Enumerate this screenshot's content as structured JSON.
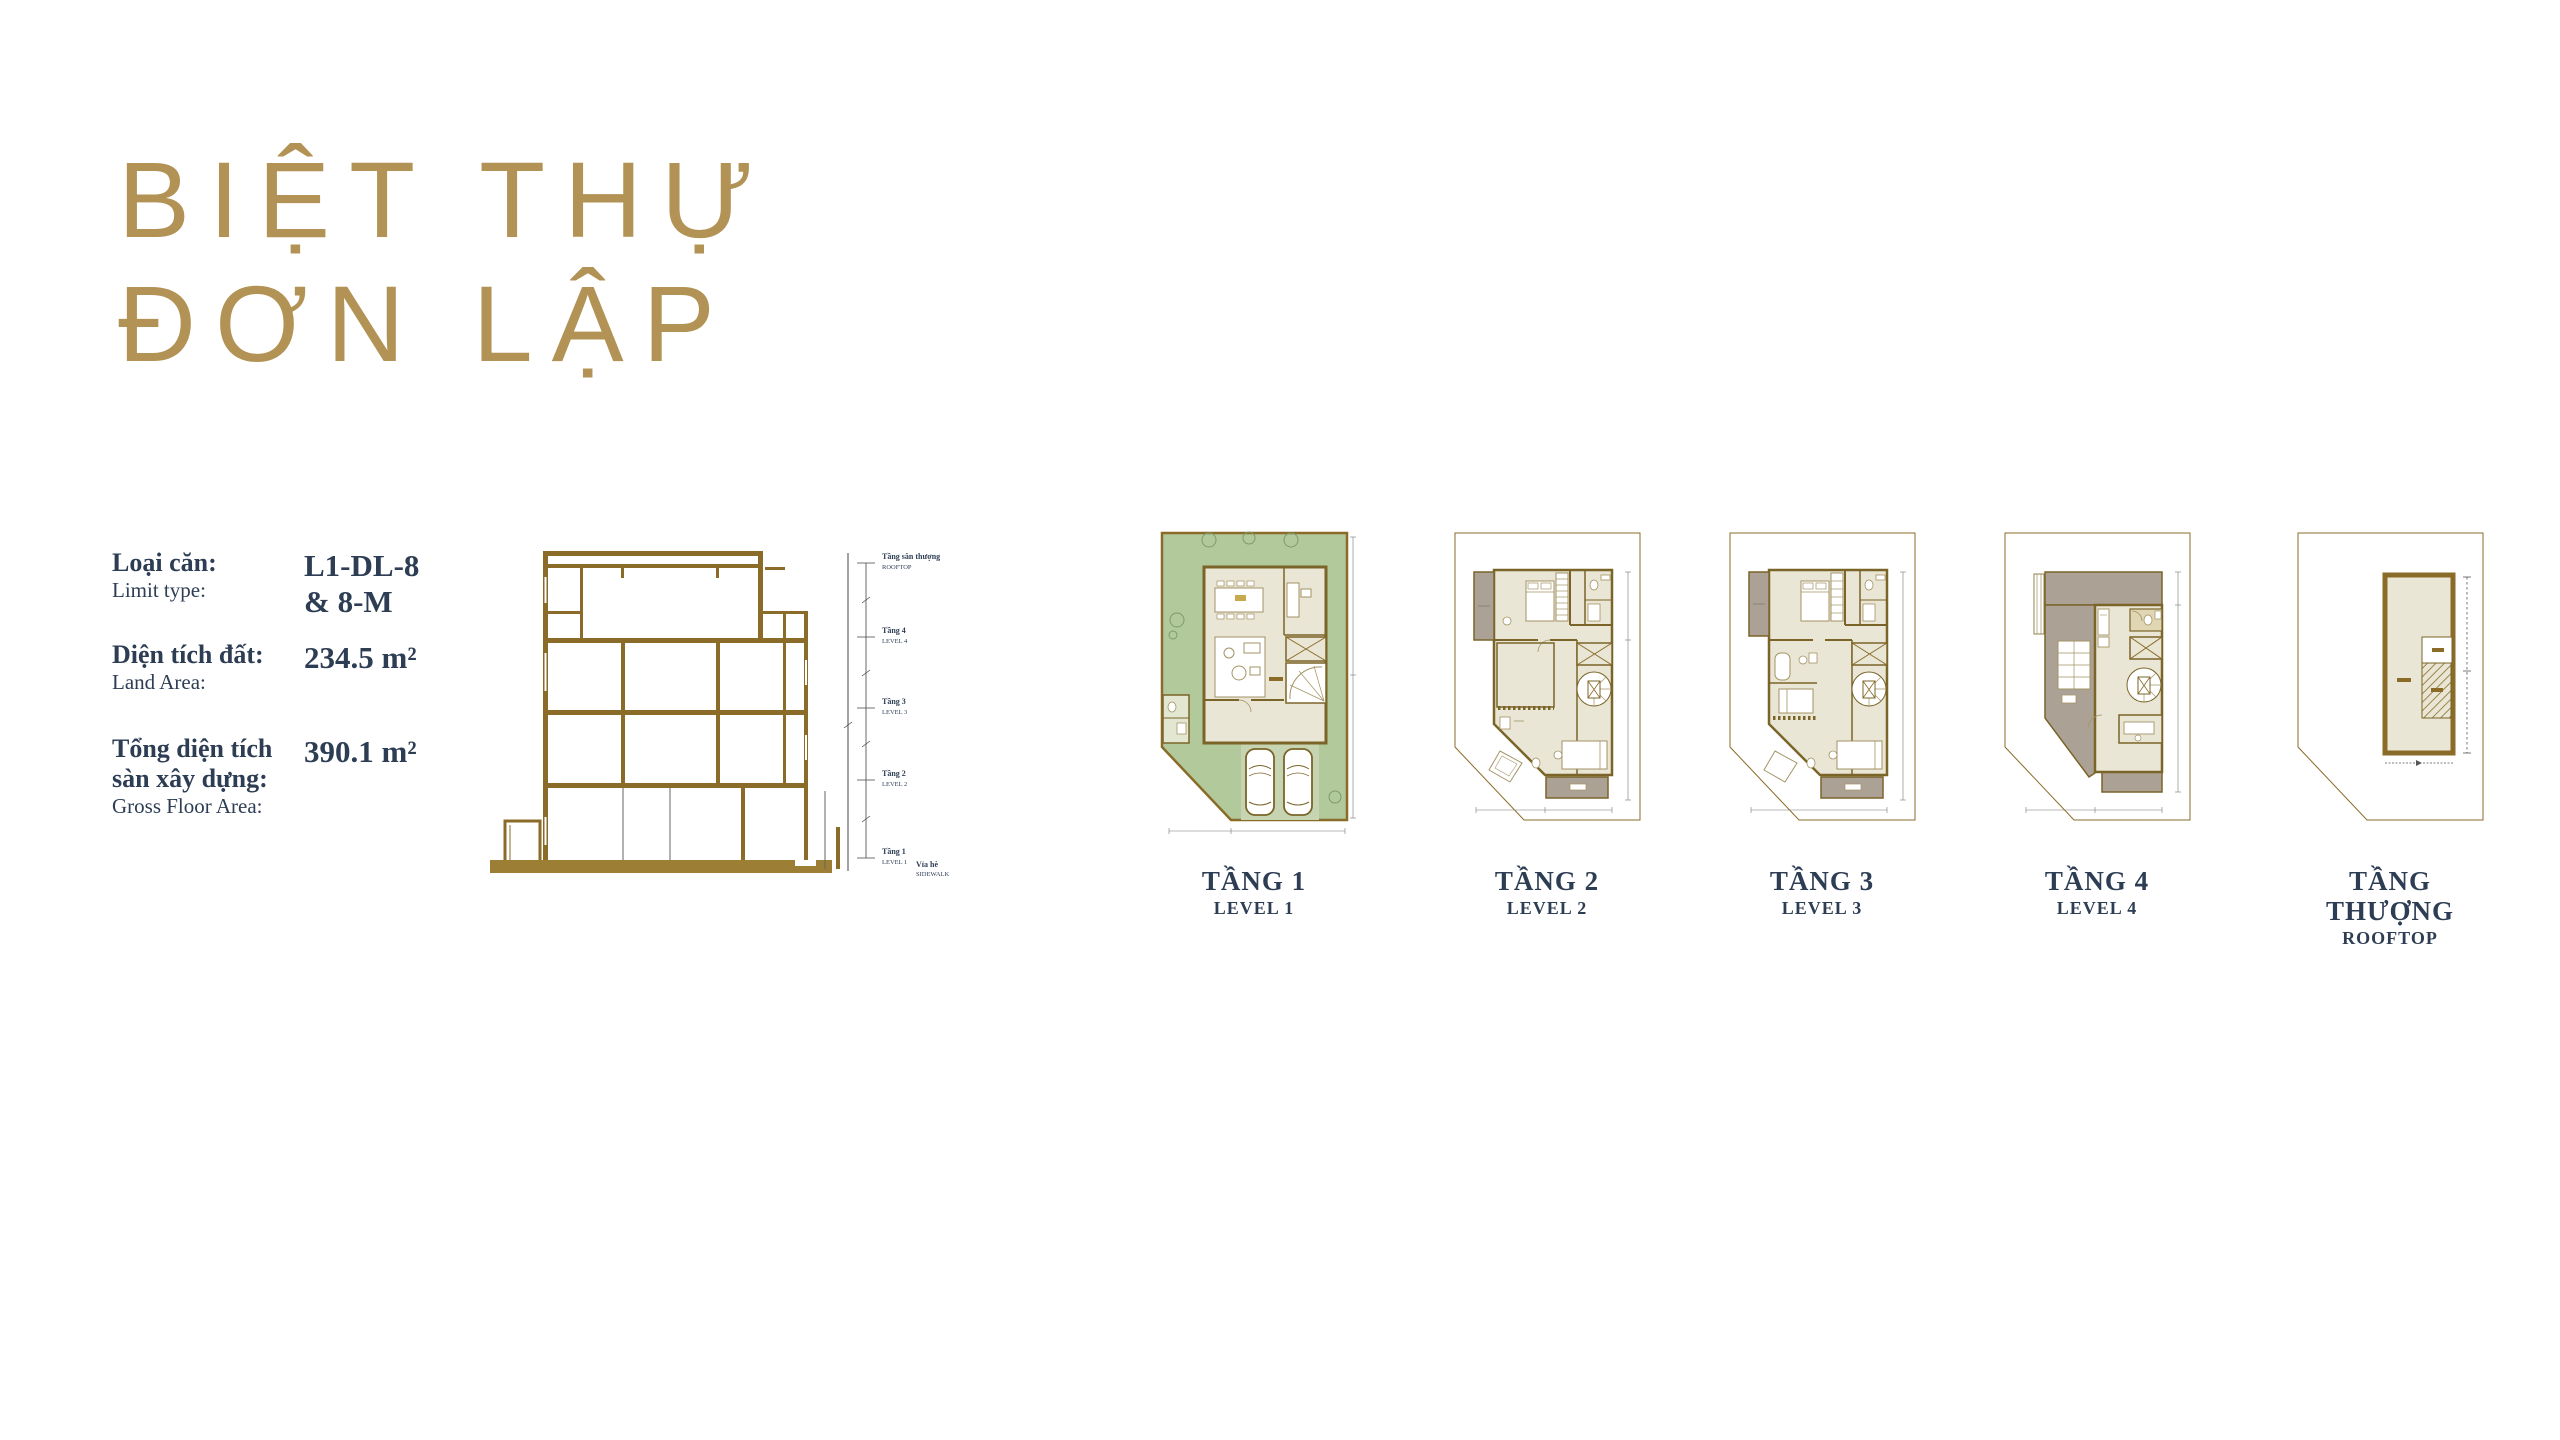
{
  "title": {
    "line1": "BIỆT THỰ",
    "line2": "ĐƠN LẬP"
  },
  "specs": {
    "unit_type": {
      "label_vi": "Loại căn:",
      "label_en": "Limit type:",
      "value_line1": "L1-DL-8",
      "value_line2": "& 8-M"
    },
    "land_area": {
      "label_vi": "Diện tích đất:",
      "label_en": "Land Area:",
      "value": "234.5 m²"
    },
    "gross_floor_area": {
      "label_vi_line1": "Tổng diện tích",
      "label_vi_line2": "sàn xây dựng:",
      "label_en": "Gross Floor Area:",
      "value": "390.1 m²"
    }
  },
  "section_drawing": {
    "levels": [
      {
        "vi": "Tầng sân thượng",
        "en": "ROOFTOP"
      },
      {
        "vi": "Tầng 4",
        "en": "LEVEL 4"
      },
      {
        "vi": "Tầng 3",
        "en": "LEVEL 3"
      },
      {
        "vi": "Tầng 2",
        "en": "LEVEL 2"
      },
      {
        "vi": "Tầng 1",
        "en": "LEVEL 1"
      }
    ],
    "ground": {
      "vi": "Vỉa hè",
      "en": "SIDEWALK"
    }
  },
  "plans": [
    {
      "vi": "TẦNG 1",
      "en": "LEVEL 1"
    },
    {
      "vi": "TẦNG 2",
      "en": "LEVEL 2"
    },
    {
      "vi": "TẦNG 3",
      "en": "LEVEL 3"
    },
    {
      "vi": "TẦNG 4",
      "en": "LEVEL 4"
    },
    {
      "vi": "TẦNG THƯỢNG",
      "en": "ROOFTOP"
    }
  ],
  "colors": {
    "accent_gold": "#b29355",
    "drawing_olive": "#8a6b28",
    "ground_gold": "#9c7f35",
    "text_navy": "#2d3d54",
    "lawn_green": "#b2c99c",
    "floor_beige": "#e9e6d5",
    "terrace_gray": "#aba195"
  }
}
